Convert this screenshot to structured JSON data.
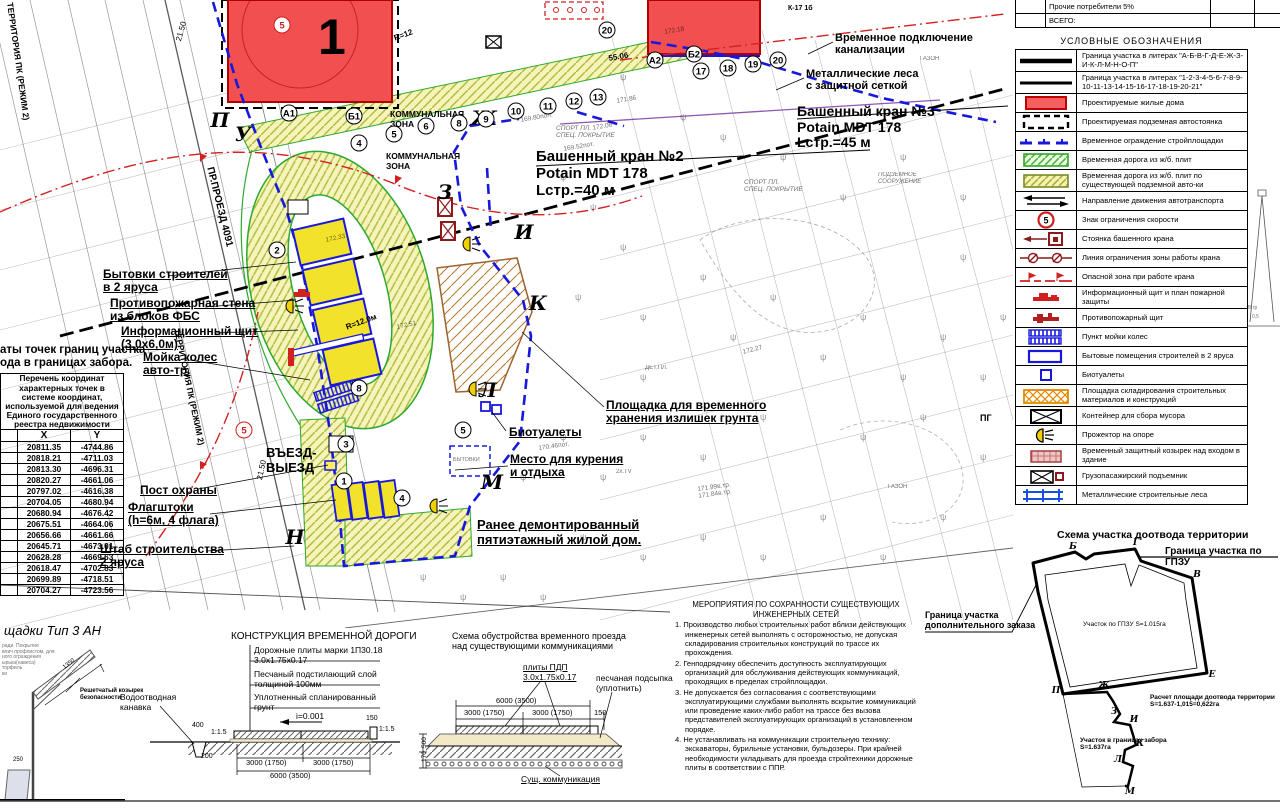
{
  "toptable": {
    "rows": [
      {
        "label": "Прочие потребители 5%"
      },
      {
        "label": "ВСЕГО:"
      }
    ]
  },
  "legend": {
    "title": "УСЛОВНЫЕ  ОБОЗНАЧЕНИЯ",
    "items": [
      {
        "sym": "line1",
        "label": "Граница участка в литерах \"А-Б-В-Г-Д-Е-Ж-З-И-К-Л-М-Н-О-П\""
      },
      {
        "sym": "line2",
        "label": "Граница участка в литерах \"1-2-3-4-5-6-7-8-9-10-11-13-14-15-16-17-18-19-20-21\""
      },
      {
        "sym": "redrect",
        "label": "Проектируемые жилые дома"
      },
      {
        "sym": "dashrect",
        "label": "Проектируемая подземная автостоянка"
      },
      {
        "sym": "bluedash",
        "label": "Временное ограждение стройплощадки"
      },
      {
        "sym": "greenhatch",
        "label": "Временная дорога из ж/б. плит"
      },
      {
        "sym": "yellowhatch",
        "label": "Временная дорога из ж/б. плит по существующей подземной авто-ки"
      },
      {
        "sym": "arrows",
        "label": "Направление движения автотранспорта"
      },
      {
        "sym": "speed",
        "label": "Знак ограничения скорости"
      },
      {
        "sym": "cranestand",
        "label": "Стоянка башенного крана"
      },
      {
        "sym": "zoneline",
        "label": "Линия ограничения зоны работы крана"
      },
      {
        "sym": "dangerline",
        "label": "Опасной зона при работе крана"
      },
      {
        "sym": "infoboard",
        "label": "Информационный щит и план пожарной защиты"
      },
      {
        "sym": "fireshield",
        "label": "Противопожарный щит"
      },
      {
        "sym": "wheelwash",
        "label": "Пункт мойки колес"
      },
      {
        "sym": "bluerect",
        "label": "Бытовые помещения строителей в 2 яруса"
      },
      {
        "sym": "bluesquare",
        "label": "Биотуалеты"
      },
      {
        "sym": "orangehatch",
        "label": "Площадка складирования строительных материалов и конструкций"
      },
      {
        "sym": "container",
        "label": "Контейнер для сбора мусора"
      },
      {
        "sym": "floodlight",
        "label": "Прожектор на опоре"
      },
      {
        "sym": "canopy",
        "label": "Временный защитный козырек над входом в здание"
      },
      {
        "sym": "hoist",
        "label": "Грузопасажирский подъемник"
      },
      {
        "sym": "scaffold",
        "label": "Металлические строительные леса"
      }
    ]
  },
  "coords": {
    "title": "аты точек границ участка\nода в границах забора.",
    "head_small": "Перечень координат характерных точек в системе координат, используемой для ведения Единого государственного реестра недвижимости",
    "col_x": "X",
    "col_y": "Y",
    "rows": [
      [
        "20811.35",
        "-4744.86"
      ],
      [
        "20818.21",
        "-4711.03"
      ],
      [
        "20813.30",
        "-4696.31"
      ],
      [
        "20820.27",
        "-4661.06"
      ],
      [
        "20797.02",
        "-4616.38"
      ],
      [
        "20704.05",
        "-4680.94"
      ],
      [
        "20680.94",
        "-4676.42"
      ],
      [
        "20675.51",
        "-4664.06"
      ],
      [
        "20656.66",
        "-4661.66"
      ],
      [
        "20645.71",
        "-4673.01"
      ],
      [
        "20628.28",
        "-4669.63"
      ],
      [
        "20618.47",
        "-4702.83"
      ],
      [
        "20699.89",
        "-4718.51"
      ],
      [
        "20704.27",
        "-4723.56"
      ]
    ]
  },
  "notes": {
    "title": "МЕРОПРИЯТИЯ ПО СОХРАННОСТИ СУЩЕСТВУЮЩИХ\nИНЖЕНЕРНЫХ СЕТЕЙ",
    "items": [
      "Производство любых строительных работ вблизи действующих инженерных сетей выполнять с осторожностью, не допуская складирования строительных конструкций по трассе их прохождения.",
      "Генподрядчику обеспечить доступность эксплуатирующих организаций для обслуживания действующих коммуникаций, проходящих в пределах стройплощадки.",
      "Не допускается без согласования с соответствующими эксплуатирующими службами выполнять вскрытие коммуникаций или проведение каких-либо работ на трассе без вызова представителей эксплуатирующих организаций в установленном порядке.",
      "Не устанавливать на коммуникации строительную технику: экскаваторы, бурильные установки, бульдозеры. При крайней необходимости укладывать для проезда стройтехники дорожные плиты в соответствии с ППР."
    ]
  },
  "plan": {
    "labels": [
      {
        "n": "label-bytovki",
        "t": "Бытовки строителей\nв 2 яруса",
        "x": 103,
        "y": 268,
        "s": 12,
        "b": 1,
        "u": 1
      },
      {
        "n": "label-firewall",
        "t": "Противопожарная стена\nиз блоков ФБС",
        "x": 110,
        "y": 297,
        "s": 12,
        "b": 1,
        "u": 1
      },
      {
        "n": "label-infoboard",
        "t": "Информационный щит\n(3,0х6,0м)",
        "x": 121,
        "y": 325,
        "s": 12,
        "b": 1,
        "u": 1
      },
      {
        "n": "label-wheelwash",
        "t": "Мойка колес\nавто-тр.",
        "x": 143,
        "y": 351,
        "s": 12,
        "b": 1,
        "u": 1
      },
      {
        "n": "label-guardpost",
        "t": "Пост охраны",
        "x": 140,
        "y": 484,
        "s": 12,
        "b": 1,
        "u": 1
      },
      {
        "n": "label-flagpoles",
        "t": "Флагштоки\n(h=6м, 4 флага)",
        "x": 128,
        "y": 501,
        "s": 12,
        "b": 1,
        "u": 1
      },
      {
        "n": "label-hq",
        "t": "Штаб строительства\n2 яруса",
        "x": 100,
        "y": 543,
        "s": 12,
        "b": 1,
        "u": 1
      },
      {
        "n": "label-crane2",
        "t": "Башенный кран №2\nPotain MDT 178\nLстр.=40 м",
        "x": 536,
        "y": 149,
        "s": 15,
        "b": 1
      },
      {
        "n": "label-crane3",
        "t": "Башенный кран №3\nPotain MDT 178\nLстр.=45 м",
        "x": 797,
        "y": 104,
        "s": 14,
        "b": 1
      },
      {
        "n": "label-sewer",
        "t": "Временное подключение\nканализации",
        "x": 835,
        "y": 32,
        "s": 11,
        "b": 1
      },
      {
        "n": "label-scaffold",
        "t": "Металлические леса\nс защитной сеткой",
        "x": 806,
        "y": 68,
        "s": 11,
        "b": 1
      },
      {
        "n": "label-soil",
        "t": "Площадка для временного\nхранения излишек грунта",
        "x": 606,
        "y": 399,
        "s": 12,
        "b": 1,
        "u": 1
      },
      {
        "n": "label-biotoilets",
        "t": "Биотуалеты",
        "x": 509,
        "y": 426,
        "s": 12,
        "b": 1,
        "u": 1
      },
      {
        "n": "label-smoking",
        "t": "Место для курения\nи отдыха",
        "x": 510,
        "y": 453,
        "s": 12,
        "b": 1,
        "u": 1
      },
      {
        "n": "label-demolished",
        "t": "Ранее демонтированный\nпятиэтажный жилой дом.",
        "x": 477,
        "y": 518,
        "s": 13,
        "b": 1,
        "u": 1
      },
      {
        "n": "label-entrance",
        "t": "ВЪЕЗД-\nВЫЕЗД",
        "x": 266,
        "y": 446,
        "s": 13,
        "b": 1
      },
      {
        "t": "КОММУНАЛЬНАЯ\nЗОНА",
        "x": 390,
        "y": 110,
        "s": 8.5,
        "b": 1
      },
      {
        "t": "КОММУНАЛЬНАЯ\nЗОНА",
        "x": 386,
        "y": 152,
        "s": 8.5,
        "b": 1
      },
      {
        "t": "ТЕРРИТОРИЯ ПК (РЕЖИМ 2)",
        "x": 14,
        "y": 2,
        "s": 8.5,
        "b": 1,
        "r": 82
      },
      {
        "t": "ТЕРРИТОРИЯ ПК (РЕЖИМ 2)",
        "x": 181,
        "y": 328,
        "s": 8.5,
        "b": 1,
        "r": 78
      },
      {
        "t": "ПР.ПРОЕЗД 4091",
        "x": 215,
        "y": 166,
        "s": 10,
        "b": 1,
        "r": 76
      },
      {
        "t": "СПОРТ ПЛ.\nСПЕЦ. ПОКРЫТИЕ",
        "x": 556,
        "y": 125,
        "s": 6.5,
        "i": 1,
        "o": 1
      },
      {
        "t": "СПОРТ ПЛ.\nСПЕЦ. ПОКРЫТИЕ",
        "x": 744,
        "y": 179,
        "s": 6.5,
        "i": 1,
        "o": 1
      },
      {
        "t": "ПОДЗЕМНОЕ\nСООРУЖЕНИЕ",
        "x": 878,
        "y": 172,
        "s": 6,
        "i": 1,
        "o": 1
      },
      {
        "t": "ГАЗОН",
        "x": 920,
        "y": 56,
        "s": 6,
        "o": 1
      },
      {
        "t": "ГАЗОН",
        "x": 888,
        "y": 484,
        "s": 6,
        "o": 1
      },
      {
        "t": "ДЕТ.ПЛ.",
        "x": 645,
        "y": 365,
        "s": 6,
        "o": 1
      },
      {
        "t": "БЫТОВКИ",
        "x": 453,
        "y": 457,
        "s": 5.5,
        "o": 1
      },
      {
        "n": "label-hydrant",
        "t": "ПГ",
        "x": 980,
        "y": 413,
        "s": 9,
        "b": 1
      },
      {
        "t": "169.52пот.",
        "x": 563,
        "y": 146,
        "s": 6.5,
        "o": 1,
        "r": -10
      },
      {
        "t": "169.80пол.",
        "x": 520,
        "y": 117,
        "s": 6.5,
        "o": 1,
        "r": -10
      },
      {
        "t": "172.06",
        "x": 592,
        "y": 125,
        "s": 6.5,
        "o": 1,
        "r": -10
      },
      {
        "t": "171.86",
        "x": 616,
        "y": 98,
        "s": 6.5,
        "o": 1,
        "r": -10
      },
      {
        "t": "172.18",
        "x": 664,
        "y": 29,
        "s": 6.5,
        "o": 1,
        "r": -10
      },
      {
        "t": "172.27",
        "x": 742,
        "y": 349,
        "s": 6.5,
        "o": 1,
        "r": -14
      },
      {
        "t": "172.33",
        "x": 325,
        "y": 237,
        "s": 6.5,
        "o": 1,
        "r": -12
      },
      {
        "t": "172.51",
        "x": 396,
        "y": 324,
        "s": 6.5,
        "o": 1,
        "r": -12
      },
      {
        "t": "170.46пот.",
        "x": 538,
        "y": 445,
        "s": 6.5,
        "o": 1,
        "r": -8
      },
      {
        "t": "171.99в.тр.\n171.84в.тр.",
        "x": 697,
        "y": 486,
        "s": 6.5,
        "o": 1,
        "r": -8
      },
      {
        "t": "2х.TV",
        "x": 616,
        "y": 469,
        "s": 6,
        "o": 1
      },
      {
        "t": "К-17 1б",
        "x": 788,
        "y": 5,
        "s": 7,
        "b": 1
      },
      {
        "t": "55.06",
        "x": 608,
        "y": 55,
        "s": 8,
        "b": 1,
        "r": -10
      },
      {
        "t": "21.50",
        "x": 175,
        "y": 40,
        "s": 8,
        "r": -74
      },
      {
        "t": "21.50",
        "x": 256,
        "y": 479,
        "s": 8,
        "r": -78
      },
      {
        "t": "R=12.0м",
        "x": 345,
        "y": 324,
        "s": 8,
        "b": 1,
        "r": -20
      },
      {
        "t": "R=12",
        "x": 393,
        "y": 35,
        "s": 8,
        "b": 1,
        "r": -20
      },
      {
        "n": "road-section-title",
        "t": "КОНСТРУКЦИЯ ВРЕМЕННОЙ ДОРОГИ",
        "x": 231,
        "y": 631,
        "s": 10
      },
      {
        "t": "Дорожные плиты марки 1П30.18\n3.0х1.75х0.17",
        "x": 254,
        "y": 646,
        "s": 8.5
      },
      {
        "t": "Песчаный подстилающий слой\nтолщиной 100мм",
        "x": 254,
        "y": 670,
        "s": 8.5
      },
      {
        "t": "Уплотненный спланированный\nгрунт",
        "x": 254,
        "y": 693,
        "s": 8.5
      },
      {
        "t": "Водоотводная\nканавка",
        "x": 120,
        "y": 693,
        "s": 8.5
      },
      {
        "t": "i=0.001",
        "x": 296,
        "y": 712,
        "s": 8.5
      },
      {
        "t": "400",
        "x": 192,
        "y": 722,
        "s": 7
      },
      {
        "t": "1:1.5",
        "x": 211,
        "y": 729,
        "s": 7
      },
      {
        "t": "150",
        "x": 366,
        "y": 715,
        "s": 7
      },
      {
        "t": "1:1.5",
        "x": 379,
        "y": 726,
        "s": 7
      },
      {
        "t": "200",
        "x": 201,
        "y": 753,
        "s": 7
      },
      {
        "t": "3000 (1750)",
        "x": 246,
        "y": 759,
        "s": 7.5
      },
      {
        "t": "3000 (1750)",
        "x": 313,
        "y": 759,
        "s": 7.5
      },
      {
        "t": "6000 (3500)",
        "x": 270,
        "y": 772,
        "s": 7.5
      },
      {
        "n": "crossing-section-title",
        "t": "Схема обустройства временного проезда\nнад существующими коммуникациями",
        "x": 452,
        "y": 631,
        "s": 9
      },
      {
        "t": "плиты ПДП\n3.0х1.75х0.17",
        "x": 523,
        "y": 663,
        "s": 8.5,
        "u": 1
      },
      {
        "t": "песчаная подсыпка\n(уплотнить)",
        "x": 596,
        "y": 674,
        "s": 8.5
      },
      {
        "t": "6000 (3500)",
        "x": 496,
        "y": 697,
        "s": 7.5
      },
      {
        "t": "3000 (1750)",
        "x": 464,
        "y": 709,
        "s": 7.5
      },
      {
        "t": "3000 (1750)",
        "x": 532,
        "y": 709,
        "s": 7.5
      },
      {
        "t": "150",
        "x": 594,
        "y": 709,
        "s": 7.5
      },
      {
        "t": "Сущ. коммуникация",
        "x": 521,
        "y": 775,
        "s": 8.5,
        "u": 1
      },
      {
        "t": "500",
        "x": 421,
        "y": 748,
        "s": 6.5,
        "r": -90
      },
      {
        "t": "170",
        "x": 421,
        "y": 762,
        "s": 6.5,
        "r": -90
      },
      {
        "n": "dootvod-title",
        "t": "Схема участка доотвода территории",
        "x": 1057,
        "y": 530,
        "s": 10.5,
        "b": 1
      },
      {
        "n": "label-gpzu-border",
        "t": "Граница участка по ГПЗУ",
        "x": 1165,
        "y": 546,
        "s": 10,
        "b": 1
      },
      {
        "t": "Участок по ГПЗУ S=1.015га",
        "x": 1083,
        "y": 621,
        "s": 6.5
      },
      {
        "t": "Расчет площади доотвода территории\nS=1.637-1,015=0,622га",
        "x": 1150,
        "y": 694,
        "s": 6.5,
        "b": 1
      },
      {
        "t": "Участок в границах забора\nS=1.637га",
        "x": 1080,
        "y": 737,
        "s": 6.5,
        "b": 1
      },
      {
        "n": "label-extra-border",
        "t": "Граница участка\nдополнительного заказа",
        "x": 925,
        "y": 610,
        "s": 9,
        "b": 1
      },
      {
        "n": "fence-detail-title",
        "t": "щадки Тип 3 АН",
        "x": 4,
        "y": 624,
        "s": 13,
        "i": 1
      },
      {
        "t": "Решетчатый козырек\nбезопасности",
        "x": 80,
        "y": 688,
        "s": 6,
        "b": 1
      },
      {
        "t": "1350",
        "x": 62,
        "y": 666,
        "s": 6,
        "r": -38
      },
      {
        "t": "250",
        "x": 13,
        "y": 757,
        "s": 6
      },
      {
        "t": "ради. Покрытие\nвлич профлистом, для\nного ограждения\nырька(навеса)\nторфиль\nки",
        "x": 2,
        "y": 644,
        "s": 5,
        "o": 1
      },
      {
        "t": "В гр",
        "x": 1248,
        "y": 306,
        "s": 5,
        "o": 1
      },
      {
        "t": "0,5",
        "x": 1252,
        "y": 315,
        "s": 5,
        "o": 1
      }
    ],
    "letters": [
      {
        "t": "П",
        "x": 220,
        "y": 120
      },
      {
        "t": "У",
        "x": 243,
        "y": 134
      },
      {
        "t": "Ж",
        "x": 484,
        "y": 118
      },
      {
        "t": "З",
        "x": 445,
        "y": 192
      },
      {
        "t": "И",
        "x": 524,
        "y": 232
      },
      {
        "t": "К",
        "x": 538,
        "y": 303
      },
      {
        "t": "Л",
        "x": 488,
        "y": 390
      },
      {
        "t": "М",
        "x": 492,
        "y": 482
      },
      {
        "t": "Н",
        "x": 295,
        "y": 537
      }
    ],
    "circles": [
      {
        "t": "2",
        "x": 277,
        "y": 250
      },
      {
        "t": "3",
        "x": 346,
        "y": 444
      },
      {
        "t": "1",
        "x": 344,
        "y": 481
      },
      {
        "t": "4",
        "x": 402,
        "y": 498
      },
      {
        "t": "5",
        "x": 463,
        "y": 430
      },
      {
        "t": "8",
        "x": 359,
        "y": 388
      },
      {
        "t": "4",
        "x": 359,
        "y": 143
      },
      {
        "t": "5",
        "x": 394,
        "y": 134
      },
      {
        "t": "6",
        "x": 426,
        "y": 126
      },
      {
        "t": "8",
        "x": 459,
        "y": 123
      },
      {
        "t": "9",
        "x": 486,
        "y": 119
      },
      {
        "t": "10",
        "x": 516,
        "y": 111
      },
      {
        "t": "11",
        "x": 548,
        "y": 106
      },
      {
        "t": "12",
        "x": 574,
        "y": 101
      },
      {
        "t": "13",
        "x": 598,
        "y": 97
      },
      {
        "t": "А1",
        "x": 289,
        "y": 113
      },
      {
        "t": "Б1",
        "x": 354,
        "y": 116
      },
      {
        "t": "А2",
        "x": 655,
        "y": 60
      },
      {
        "t": "Б2",
        "x": 694,
        "y": 54
      },
      {
        "t": "17",
        "x": 701,
        "y": 71
      },
      {
        "t": "18",
        "x": 728,
        "y": 68
      },
      {
        "t": "19",
        "x": 753,
        "y": 64
      },
      {
        "t": "20",
        "x": 778,
        "y": 60
      },
      {
        "t": "20",
        "x": 607,
        "y": 30
      },
      {
        "t": "5",
        "x": 244,
        "y": 430,
        "red": 1
      },
      {
        "t": "5",
        "x": 282,
        "y": 25,
        "red": 1
      }
    ],
    "dootvod_letters": [
      {
        "t": "Б",
        "x": 1073,
        "y": 547
      },
      {
        "t": "Г",
        "x": 1136,
        "y": 543
      },
      {
        "t": "В",
        "x": 1197,
        "y": 575
      },
      {
        "t": "Е",
        "x": 1212,
        "y": 675
      },
      {
        "t": "П",
        "x": 1056,
        "y": 691
      },
      {
        "t": "Ж",
        "x": 1104,
        "y": 686
      },
      {
        "t": "З",
        "x": 1114,
        "y": 712
      },
      {
        "t": "И",
        "x": 1134,
        "y": 720
      },
      {
        "t": "К",
        "x": 1140,
        "y": 744
      },
      {
        "t": "Л",
        "x": 1118,
        "y": 760
      },
      {
        "t": "М",
        "x": 1130,
        "y": 792
      }
    ],
    "building1_number": "1"
  }
}
